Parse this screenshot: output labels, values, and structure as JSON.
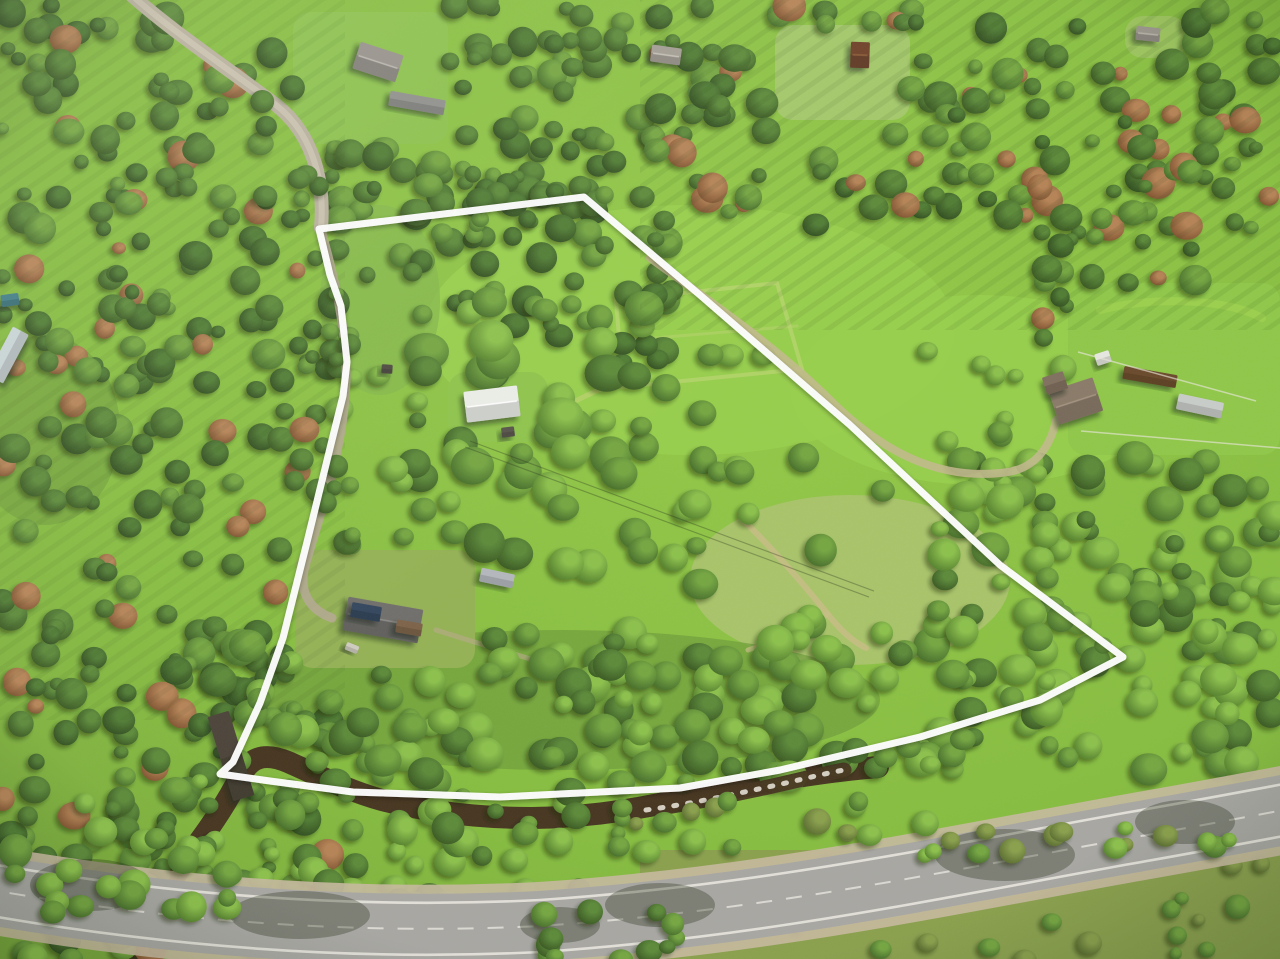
{
  "scene": {
    "description": "Aerial drone photo of a forested rural property outlined with a white boundary overlay; paved road and creek along the lower edge, meadows and scattered outbuildings inside",
    "width": 1280,
    "height": 959
  },
  "palette": {
    "meadow": "#86bd3f",
    "meadow_bright": "#97cf4b",
    "meadow_pale": "#a9c469",
    "meadow_dark": "#6f9c3a",
    "grass_olive": "#8aa04c",
    "forest_dark": "#2f4d1e",
    "forest_mid": "#486f2b",
    "canopy_bright": "#7fb544",
    "road_asphalt": "#a8a7a2",
    "road_shoulder": "#c6b99e",
    "road_marking": "#eceae2",
    "gravel": "#b8b09c",
    "gravel_center": "#cdc6b2",
    "driveway": "#b2a890",
    "dirt_track": "#c4b98f",
    "creek_water": "#46351f",
    "creek_rapids": "#efeadf",
    "boundary_white": "#ffffff",
    "shadow_green": "#17250c"
  },
  "boundary": {
    "color": "#ffffff",
    "stroke_width": 7,
    "points": "584,197 700,295 850,425 1000,565 1123,657 1040,700 920,737 780,770 680,788 500,797 353,792 270,781 220,774 233,762 260,703 283,638 308,538 332,440 343,396 347,362 341,306 330,275 319,229"
  },
  "roads": {
    "paved_road": {
      "d": "M-20 888 C150 918 340 936 540 926 C760 911 930 874 1130 838 C1210 824 1262 814 1300 807",
      "top_edge_d": "M-20 862 C150 892 340 910 540 900 C760 885 930 848 1130 812 C1210 798 1262 788 1300 781",
      "bottom_edge_d": "M-20 914 C150 944 340 962 540 952 C760 937 930 900 1130 864 C1210 850 1262 840 1300 833",
      "color": "#a8a7a2",
      "shoulder_color": "#c6b99e",
      "edge_line_color": "#eceae2",
      "width": 70
    },
    "gravel_road_nw": {
      "d": "M128 -8 C170 30 230 70 276 105 C312 133 325 180 321 228",
      "color": "#b8b09c",
      "center_color": "#cdc6b2",
      "width": 14
    },
    "driveway_west": {
      "d": "M321 230 C335 280 347 330 346 381 C344 450 318 520 305 566 C298 592 310 610 332 618",
      "color": "#b2a890",
      "width": 9
    },
    "field_track_east": {
      "d": "M650 258 C715 305 780 350 830 400 C882 452 940 482 1008 472 C1040 467 1052 440 1056 420",
      "color": "#c4b98f",
      "width": 8
    }
  },
  "creek": {
    "d": "M140 958 C152 912 172 876 196 846 C214 822 228 800 240 777 C250 757 264 752 288 762 C320 776 346 790 382 800 C432 813 482 818 532 818 C602 817 652 806 702 795 C757 783 817 772 878 767",
    "overlay_d": "M646 810 C690 804 730 795 768 787 C800 780 822 774 844 770",
    "color": "#46351f",
    "width": 22,
    "overlay_width": 15,
    "rapids_color": "#efeadf"
  },
  "trails": [
    {
      "name": "upper-meadow-loop",
      "d": "M616 300 L777 283 L802 369 L623 387 Z",
      "color": "#b7d46b",
      "width": 4,
      "opacity": 0.8
    },
    {
      "name": "upper-meadow-mow",
      "d": "M618 341 L797 326",
      "color": "#b7d46b",
      "width": 3,
      "opacity": 0.55
    },
    {
      "name": "se-meadow-trail",
      "d": "M743 520 C770 546 800 580 826 612 C840 630 852 641 866 648",
      "color": "#c8bd85",
      "width": 6,
      "opacity": 0.85
    },
    {
      "name": "se-meadow-branch",
      "d": "M828 614 C802 632 772 642 748 650",
      "color": "#c8bd85",
      "width": 5,
      "opacity": 0.7
    },
    {
      "name": "shed-lawn-spur",
      "d": "M543 417 C570 404 592 392 614 383",
      "color": "#bcd06e",
      "width": 5,
      "opacity": 0.7
    },
    {
      "name": "homestead-east-path",
      "d": "M436 630 C480 644 520 656 560 668",
      "color": "#b5ab85",
      "width": 5,
      "opacity": 0.65
    },
    {
      "name": "right-field-mow",
      "d": "M1100 310 C1160 295 1230 300 1262 318",
      "color": "#a8d84f",
      "width": 8,
      "opacity": 0.5
    }
  ],
  "fences": [
    {
      "name": "right-field-fence-upper",
      "x1": 1078,
      "y1": 352,
      "x2": 1256,
      "y2": 401
    },
    {
      "name": "right-field-fence-lower",
      "x1": 1081,
      "y1": 431,
      "x2": 1280,
      "y2": 448
    }
  ],
  "power_lines": [
    {
      "name": "power-line-1",
      "x1": 470,
      "y1": 441,
      "x2": 874,
      "y2": 591
    },
    {
      "name": "power-line-2",
      "x1": 465,
      "y1": 447,
      "x2": 869,
      "y2": 597
    }
  ],
  "clearings": [
    {
      "name": "neighbor-lawn",
      "x": 293,
      "y": 12,
      "w": 155,
      "h": 132,
      "fill": "#8cc24c"
    },
    {
      "name": "cabin-clearing",
      "x": 775,
      "y": 25,
      "w": 135,
      "h": 95,
      "fill": "#a3c868"
    },
    {
      "name": "far-right-clearing",
      "x": 1125,
      "y": 16,
      "w": 62,
      "h": 42,
      "fill": "#9bc45c"
    },
    {
      "name": "right-field",
      "x": 1068,
      "y": 283,
      "w": 212,
      "h": 172,
      "fill": "#8fc848"
    },
    {
      "name": "homestead-clearing",
      "x": 295,
      "y": 550,
      "w": 180,
      "h": 118,
      "fill": "#94b254"
    },
    {
      "name": "shed-lawn",
      "x": 448,
      "y": 372,
      "w": 100,
      "h": 70,
      "fill": "#8ec44a"
    }
  ],
  "buildings": [
    {
      "name": "neighbor-house",
      "cx": 378,
      "cy": 62,
      "w": 45,
      "h": 28,
      "rot": 18,
      "fill": "#96918a",
      "ridge": "#bab6ae"
    },
    {
      "name": "neighbor-shed",
      "cx": 417,
      "cy": 103,
      "w": 56,
      "h": 15,
      "rot": 10,
      "fill": "#8f8f8b",
      "ridge": null
    },
    {
      "name": "top-center-house",
      "cx": 666,
      "cy": 55,
      "w": 30,
      "h": 17,
      "rot": 8,
      "fill": "#a39d93",
      "ridge": "#c5c0b6"
    },
    {
      "name": "brown-cabin",
      "cx": 860,
      "cy": 55,
      "w": 19,
      "h": 26,
      "rot": 2,
      "fill": "#6e4026",
      "ridge": "#8a5a36"
    },
    {
      "name": "far-right-cabin",
      "cx": 1148,
      "cy": 34,
      "w": 24,
      "h": 14,
      "rot": 6,
      "fill": "#99948b",
      "ridge": "#b5b0a6"
    },
    {
      "name": "left-teal-hut",
      "cx": 10,
      "cy": 300,
      "w": 18,
      "h": 12,
      "rot": -8,
      "fill": "#3f7d85",
      "ridge": null
    },
    {
      "name": "left-greenhouse",
      "cx": 8,
      "cy": 355,
      "w": 55,
      "h": 18,
      "rot": -62,
      "fill": "#c9d4d5",
      "ridge": null
    },
    {
      "name": "white-shed",
      "cx": 492,
      "cy": 404,
      "w": 54,
      "h": 31,
      "rot": -7,
      "fill": "#eceee8",
      "ridge": "#ffffff"
    },
    {
      "name": "garden-hut",
      "cx": 508,
      "cy": 432,
      "w": 13,
      "h": 10,
      "rot": -7,
      "fill": "#57524a",
      "ridge": null
    },
    {
      "name": "well-house",
      "cx": 387,
      "cy": 369,
      "w": 11,
      "h": 9,
      "rot": 4,
      "fill": "#4e4940",
      "ridge": null
    },
    {
      "name": "trailer-junk",
      "cx": 497,
      "cy": 578,
      "w": 34,
      "h": 14,
      "rot": 12,
      "fill": "#b4b8bd",
      "ridge": null
    },
    {
      "name": "old-homestead",
      "cx": 383,
      "cy": 620,
      "w": 76,
      "h": 34,
      "rot": 10,
      "fill": "#6f6e6a",
      "ridge": "#8c8b86"
    },
    {
      "name": "homestead-tarp",
      "cx": 366,
      "cy": 612,
      "w": 30,
      "h": 15,
      "rot": 10,
      "fill": "#33445c",
      "ridge": null
    },
    {
      "name": "homestead-rust",
      "cx": 409,
      "cy": 628,
      "w": 26,
      "h": 13,
      "rot": 10,
      "fill": "#7d6247",
      "ridge": null
    },
    {
      "name": "homestead-scrap",
      "cx": 352,
      "cy": 648,
      "w": 13,
      "h": 8,
      "rot": 22,
      "fill": "#cfccc0",
      "ridge": null
    },
    {
      "name": "right-house",
      "cx": 1076,
      "cy": 401,
      "w": 46,
      "h": 35,
      "rot": -18,
      "fill": "#8a7a68",
      "ridge": "#a3937f"
    },
    {
      "name": "right-house-wing",
      "cx": 1055,
      "cy": 383,
      "w": 22,
      "h": 18,
      "rot": -18,
      "fill": "#80705e",
      "ridge": null
    },
    {
      "name": "right-white-shed",
      "cx": 1103,
      "cy": 358,
      "w": 15,
      "h": 12,
      "rot": -18,
      "fill": "#e8e8e2",
      "ridge": null
    },
    {
      "name": "greenhouse",
      "cx": 1200,
      "cy": 406,
      "w": 46,
      "h": 16,
      "rot": 12,
      "fill": "#c9cdc9",
      "ridge": null
    },
    {
      "name": "garden-bed",
      "cx": 1150,
      "cy": 377,
      "w": 54,
      "h": 13,
      "rot": 10,
      "fill": "#6b4a2a",
      "ridge": null
    },
    {
      "name": "creek-bridge",
      "cx": 231,
      "cy": 756,
      "w": 22,
      "h": 88,
      "rot": -17,
      "fill": "#4b4337",
      "ridge": null
    }
  ]
}
